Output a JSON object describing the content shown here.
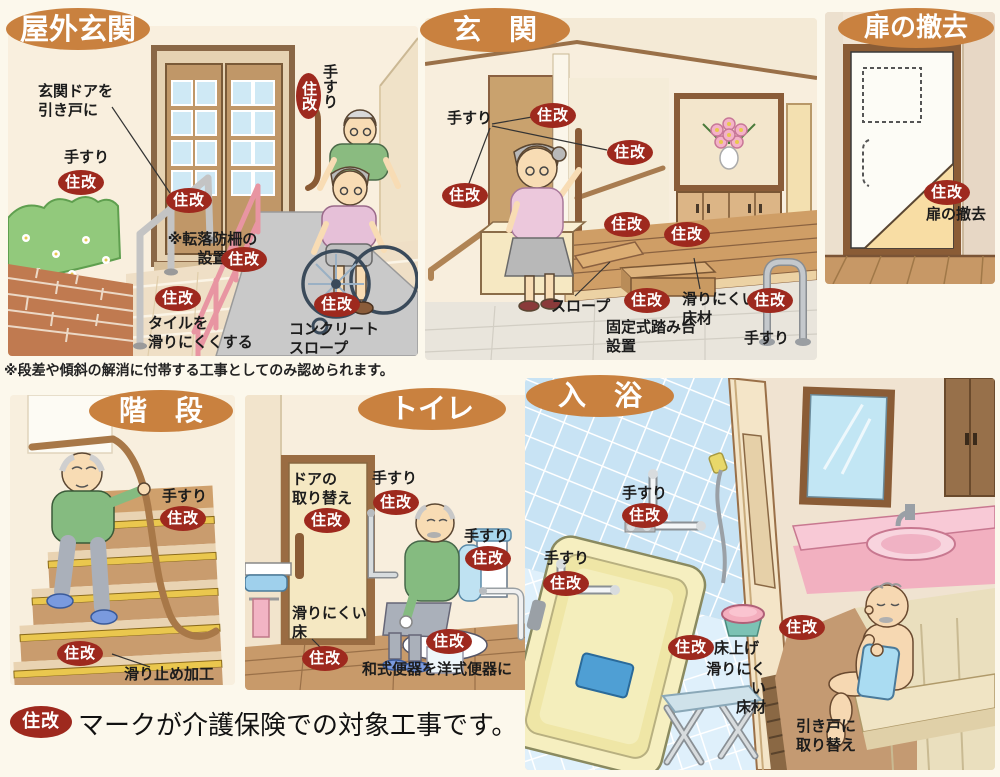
{
  "badge": {
    "text": "住改",
    "bg": "#9e291e",
    "fg": "#ffffff"
  },
  "colors": {
    "title_oval": "#c9813f",
    "page_background": "#fcf8ec",
    "badge_red": "#9e291e",
    "tile_blue": "#cfe7f6",
    "bathtub_yellow": "#f6efc0"
  },
  "panels": {
    "outdoor_entrance": {
      "title": "屋外玄関",
      "labels": {
        "door_to_sliding": "玄関ドアを\n引き戸に",
        "handrail_left": "手すり",
        "handrail_right": "手すり",
        "fall_fence": "※転落防柵の\n設置",
        "tile_antislip": "タイルを\n滑りにくくする",
        "concrete_slope": "コンクリート\nスロープ"
      },
      "note": "※段差や傾斜の解消に付帯する工事としてのみ認められます。"
    },
    "entrance": {
      "title": "玄　関",
      "labels": {
        "handrail": "手すり",
        "slope": "スロープ",
        "fixed_step": "固定式踏み台\n設置",
        "antislip_floor": "滑りにくい\n床材",
        "handrail_right": "手すり"
      }
    },
    "door_removal": {
      "title": "扉の撤去",
      "labels": {
        "door_removal": "扉の撤去"
      }
    },
    "stairs": {
      "title": "階　段",
      "labels": {
        "handrail": "手すり",
        "antislip": "滑り止め加工"
      }
    },
    "toilet": {
      "title": "トイレ",
      "labels": {
        "door_replace": "ドアの\n取り替え",
        "handrail_top": "手すり",
        "handrail_right": "手すり",
        "antislip_floor": "滑りにくい\n床",
        "western_toilet": "和式便器を洋式便器に"
      }
    },
    "bathing": {
      "title": "入　浴",
      "labels": {
        "handrail_wall": "手すり",
        "handrail_tub": "手すり",
        "floor_raise": "床上げ",
        "antislip_floor": "滑りにくい\n床材",
        "sliding_door": "引き戸に\n取り替え"
      }
    }
  },
  "footer": {
    "caption": "マークが介護保険での対象工事です。"
  }
}
